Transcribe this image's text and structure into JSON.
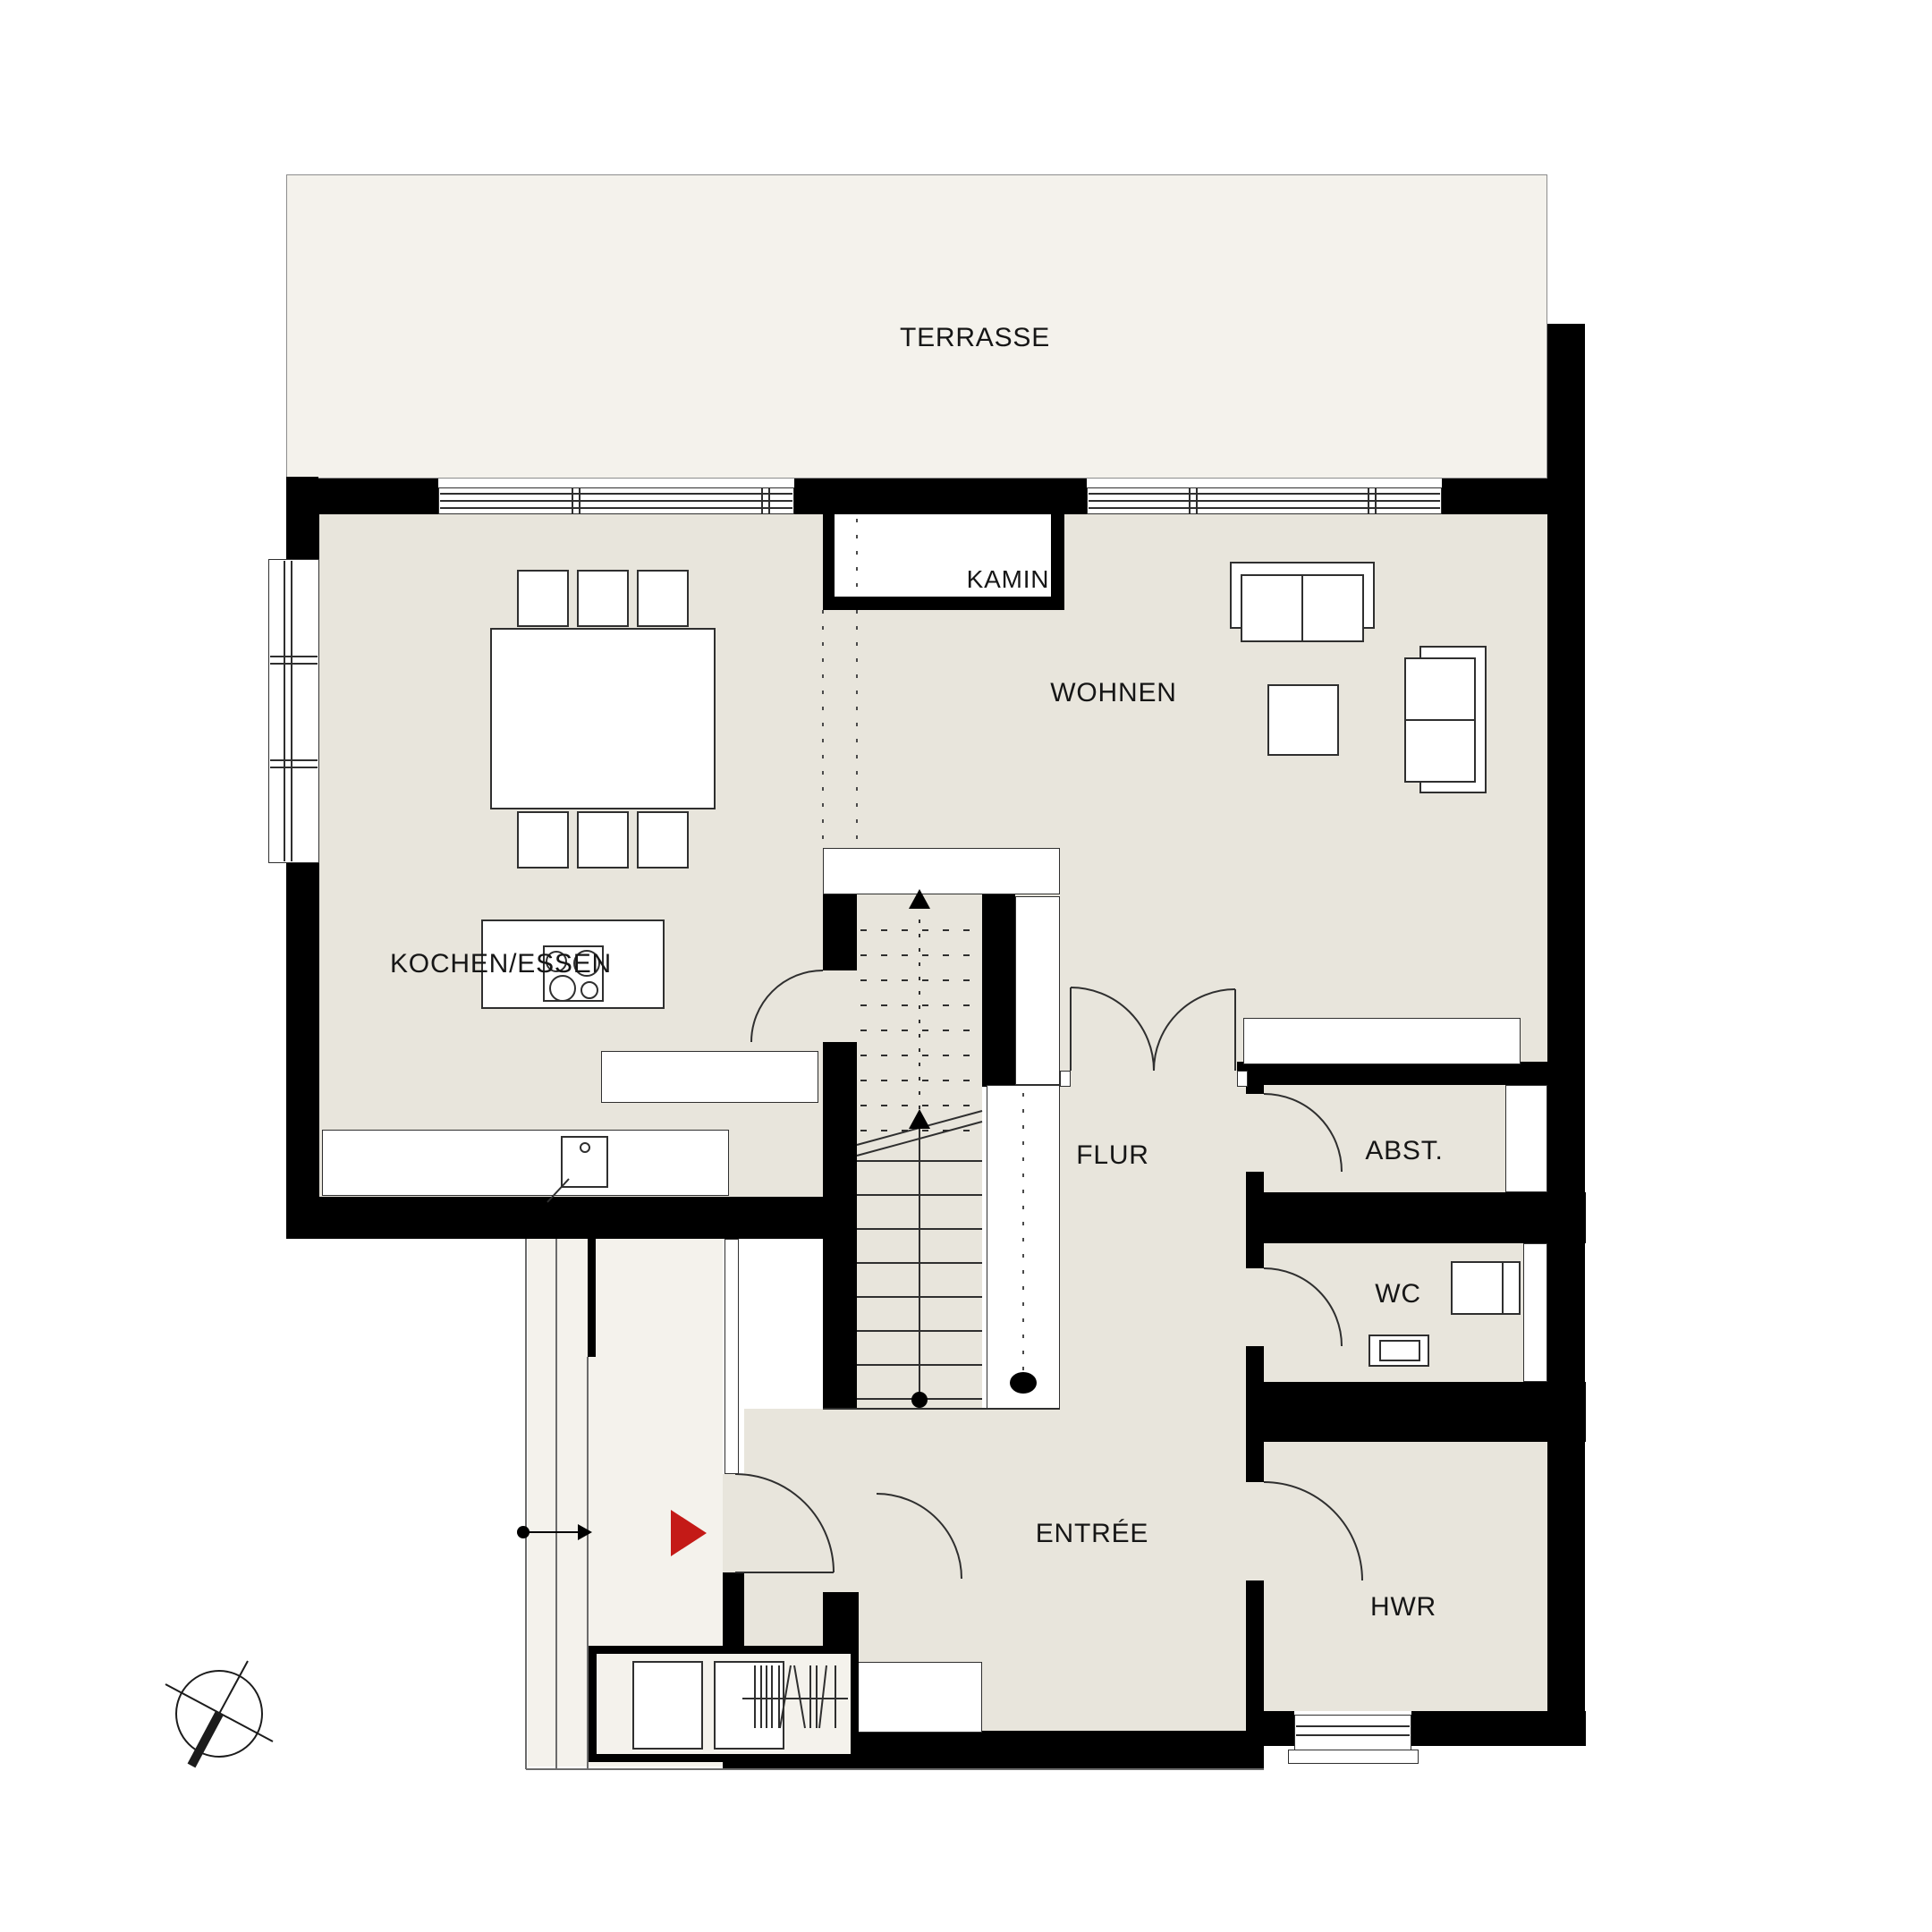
{
  "plan_type": "architectural-floor-plan",
  "labels": {
    "terrasse": "TERRASSE",
    "kamin": "KAMIN",
    "wohnen": "WOHNEN",
    "kochen_essen": "KOCHEN/ESSEN",
    "flur": "FLUR",
    "abst": "ABST.",
    "wc": "WC",
    "entree": "ENTRÉE",
    "hwr": "HWR"
  },
  "colors": {
    "wall": "#000000",
    "room": "#e8e5dc",
    "outdoor": "#f4f2ec",
    "white": "#ffffff",
    "line": "#2f2f2f",
    "red": "#c41a17"
  },
  "icons": {
    "entrance_marker": "red-right-triangle",
    "orientation_symbol": "north-compass-circle",
    "stair_direction": "up-arrow-walkline"
  }
}
